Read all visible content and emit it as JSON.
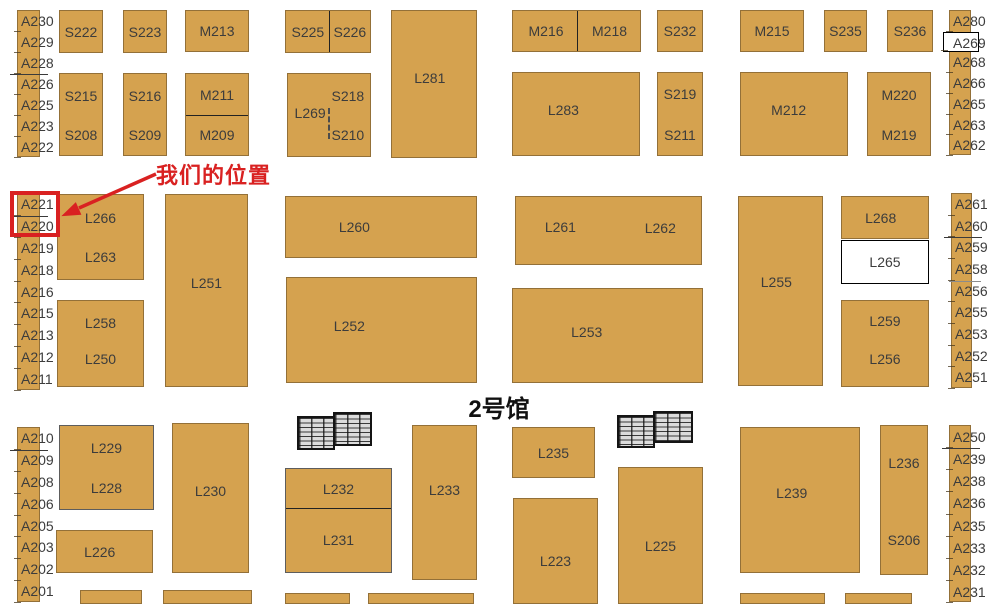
{
  "hall": {
    "title": "2号馆"
  },
  "annotation": {
    "label": "我们的位置"
  },
  "colors": {
    "booth_fill": "#d5a24f",
    "booth_border": "#5a462388",
    "label_text": "#3c3c3c",
    "divider": "#222222",
    "highlight": "#d92121",
    "hall_text": "#111111"
  },
  "strips": [
    {
      "name": "left-top",
      "x": 17,
      "y": 10,
      "w": 23,
      "h": 147,
      "labels": [
        {
          "t": "A230"
        },
        {
          "t": "A229"
        },
        {
          "t": "A228",
          "divider": true
        },
        {
          "t": "A226"
        },
        {
          "t": "A225"
        },
        {
          "t": "A223"
        },
        {
          "t": "A222"
        }
      ]
    },
    {
      "name": "left-mid",
      "x": 17,
      "y": 193,
      "w": 23,
      "h": 197,
      "labels": [
        {
          "t": "A221",
          "divider": true
        },
        {
          "t": "A220"
        },
        {
          "t": "A219"
        },
        {
          "t": "A218"
        },
        {
          "t": "A216"
        },
        {
          "t": "A215"
        },
        {
          "t": "A213"
        },
        {
          "t": "A212"
        },
        {
          "t": "A211"
        }
      ]
    },
    {
      "name": "left-bottom",
      "x": 17,
      "y": 427,
      "w": 23,
      "h": 175,
      "labels": [
        {
          "t": "A210",
          "divider": true
        },
        {
          "t": "A209"
        },
        {
          "t": "A208"
        },
        {
          "t": "A206"
        },
        {
          "t": "A205"
        },
        {
          "t": "A203"
        },
        {
          "t": "A202"
        },
        {
          "t": "A201"
        }
      ]
    },
    {
      "name": "right-top",
      "x": 949,
      "y": 10,
      "w": 22,
      "h": 145,
      "labels": [
        {
          "t": "A280"
        },
        {
          "t": "A269",
          "white_box": true
        },
        {
          "t": "A268"
        },
        {
          "t": "A266"
        },
        {
          "t": "A265"
        },
        {
          "t": "A263"
        },
        {
          "t": "A262"
        }
      ]
    },
    {
      "name": "right-mid",
      "x": 951,
      "y": 193,
      "w": 21,
      "h": 195,
      "labels": [
        {
          "t": "A261"
        },
        {
          "t": "A260",
          "divider": true
        },
        {
          "t": "A259"
        },
        {
          "t": "A258",
          "light_div": true
        },
        {
          "t": "A256"
        },
        {
          "t": "A255"
        },
        {
          "t": "A253"
        },
        {
          "t": "A252"
        },
        {
          "t": "A251"
        }
      ]
    },
    {
      "name": "right-bottom",
      "x": 949,
      "y": 425,
      "w": 22,
      "h": 177,
      "labels": [
        {
          "t": "A250",
          "divider": true
        },
        {
          "t": "A239"
        },
        {
          "t": "A238"
        },
        {
          "t": "A236"
        },
        {
          "t": "A235"
        },
        {
          "t": "A233"
        },
        {
          "t": "A232"
        },
        {
          "t": "A231"
        }
      ]
    }
  ],
  "booths": [
    {
      "id": "S222",
      "x": 59,
      "y": 10,
      "w": 44,
      "h": 43,
      "labels": [
        {
          "t": "S222"
        }
      ]
    },
    {
      "id": "S223",
      "x": 123,
      "y": 10,
      "w": 44,
      "h": 43,
      "labels": [
        {
          "t": "S223"
        }
      ]
    },
    {
      "id": "M213",
      "x": 185,
      "y": 10,
      "w": 64,
      "h": 42,
      "labels": [
        {
          "t": "M213"
        }
      ]
    },
    {
      "id": "S225-S226",
      "x": 285,
      "y": 10,
      "w": 86,
      "h": 43,
      "vdiv": 51,
      "labels": [
        {
          "t": "S225",
          "lx": 26
        },
        {
          "t": "S226",
          "lx": 76
        }
      ]
    },
    {
      "id": "L281",
      "x": 391,
      "y": 10,
      "w": 86,
      "h": 148,
      "labels": [
        {
          "t": "L281",
          "lx": 45,
          "ly": 46
        }
      ]
    },
    {
      "id": "M216-M218",
      "x": 512,
      "y": 10,
      "w": 129,
      "h": 42,
      "vdiv": 50,
      "labels": [
        {
          "t": "M216",
          "lx": 26
        },
        {
          "t": "M218",
          "lx": 76
        }
      ]
    },
    {
      "id": "S232",
      "x": 657,
      "y": 10,
      "w": 46,
      "h": 42,
      "labels": [
        {
          "t": "S232"
        }
      ]
    },
    {
      "id": "M215",
      "x": 740,
      "y": 10,
      "w": 64,
      "h": 42,
      "labels": [
        {
          "t": "M215"
        }
      ]
    },
    {
      "id": "S235",
      "x": 824,
      "y": 10,
      "w": 43,
      "h": 42,
      "labels": [
        {
          "t": "S235"
        }
      ]
    },
    {
      "id": "S236",
      "x": 887,
      "y": 10,
      "w": 46,
      "h": 42,
      "labels": [
        {
          "t": "S236"
        }
      ]
    },
    {
      "id": "S215-S208",
      "x": 59,
      "y": 73,
      "w": 44,
      "h": 83,
      "labels": [
        {
          "t": "S215",
          "ly": 27
        },
        {
          "t": "S208",
          "ly": 75
        }
      ]
    },
    {
      "id": "S216-S209",
      "x": 123,
      "y": 73,
      "w": 44,
      "h": 83,
      "labels": [
        {
          "t": "S216",
          "ly": 27
        },
        {
          "t": "S209",
          "ly": 75
        }
      ]
    },
    {
      "id": "M211-M209",
      "x": 185,
      "y": 73,
      "w": 64,
      "h": 83,
      "hdiv": 50,
      "labels": [
        {
          "t": "M211",
          "ly": 26
        },
        {
          "t": "M209",
          "ly": 75
        }
      ]
    },
    {
      "id": "L269-S218-S210",
      "x": 287,
      "y": 73,
      "w": 84,
      "h": 84,
      "dash": true,
      "labels": [
        {
          "t": "L269",
          "lx": 27,
          "ly": 47
        },
        {
          "t": "S218",
          "lx": 73,
          "ly": 27
        },
        {
          "t": "S210",
          "lx": 73,
          "ly": 74
        }
      ]
    },
    {
      "id": "L283",
      "x": 512,
      "y": 72,
      "w": 128,
      "h": 84,
      "labels": [
        {
          "t": "L283",
          "lx": 40,
          "ly": 45
        }
      ]
    },
    {
      "id": "S219-S211",
      "x": 657,
      "y": 72,
      "w": 46,
      "h": 84,
      "labels": [
        {
          "t": "S219",
          "ly": 26
        },
        {
          "t": "S211",
          "ly": 76
        }
      ]
    },
    {
      "id": "M212",
      "x": 740,
      "y": 72,
      "w": 108,
      "h": 84,
      "labels": [
        {
          "t": "M212",
          "lx": 45,
          "ly": 45
        }
      ]
    },
    {
      "id": "M220-M219",
      "x": 867,
      "y": 72,
      "w": 64,
      "h": 84,
      "labels": [
        {
          "t": "M220",
          "ly": 27
        },
        {
          "t": "M219",
          "ly": 75
        }
      ]
    },
    {
      "id": "L266-L263",
      "x": 57,
      "y": 194,
      "w": 87,
      "h": 86,
      "labels": [
        {
          "t": "L266",
          "ly": 27
        },
        {
          "t": "L263",
          "ly": 74
        }
      ]
    },
    {
      "id": "L258-L250",
      "x": 57,
      "y": 300,
      "w": 87,
      "h": 87,
      "labels": [
        {
          "t": "L258",
          "ly": 26
        },
        {
          "t": "L250",
          "ly": 68
        }
      ]
    },
    {
      "id": "L251",
      "x": 165,
      "y": 194,
      "w": 83,
      "h": 193,
      "labels": [
        {
          "t": "L251",
          "ly": 46
        }
      ]
    },
    {
      "id": "L260",
      "x": 285,
      "y": 196,
      "w": 192,
      "h": 62,
      "labels": [
        {
          "t": "L260",
          "lx": 36
        }
      ]
    },
    {
      "id": "L261-L262",
      "x": 515,
      "y": 196,
      "w": 187,
      "h": 69,
      "labels": [
        {
          "t": "L261",
          "lx": 24,
          "ly": 45
        },
        {
          "t": "L262",
          "lx": 78,
          "ly": 47
        }
      ]
    },
    {
      "id": "L252",
      "x": 286,
      "y": 277,
      "w": 191,
      "h": 106,
      "labels": [
        {
          "t": "L252",
          "lx": 33,
          "ly": 46
        }
      ]
    },
    {
      "id": "L253",
      "x": 512,
      "y": 288,
      "w": 191,
      "h": 95,
      "labels": [
        {
          "t": "L253",
          "lx": 39,
          "ly": 46
        }
      ]
    },
    {
      "id": "L255",
      "x": 738,
      "y": 196,
      "w": 85,
      "h": 190,
      "labels": [
        {
          "t": "L255",
          "lx": 45,
          "ly": 45
        }
      ]
    },
    {
      "id": "L268",
      "x": 841,
      "y": 196,
      "w": 88,
      "h": 43,
      "labels": [
        {
          "t": "L268",
          "lx": 45
        }
      ]
    },
    {
      "id": "L265",
      "x": 841,
      "y": 240,
      "w": 88,
      "h": 44,
      "style": "white",
      "labels": [
        {
          "t": "L265"
        }
      ]
    },
    {
      "id": "L259-L256",
      "x": 841,
      "y": 300,
      "w": 88,
      "h": 87,
      "labels": [
        {
          "t": "L259",
          "ly": 24
        },
        {
          "t": "L256",
          "ly": 68
        }
      ]
    },
    {
      "id": "L229-L228",
      "x": 59,
      "y": 425,
      "w": 95,
      "h": 85,
      "strong": true,
      "labels": [
        {
          "t": "L229",
          "ly": 26
        },
        {
          "t": "L228",
          "ly": 75
        }
      ]
    },
    {
      "id": "L226",
      "x": 56,
      "y": 530,
      "w": 97,
      "h": 43,
      "labels": [
        {
          "t": "L226",
          "lx": 45
        }
      ]
    },
    {
      "id": "L230",
      "x": 172,
      "y": 423,
      "w": 77,
      "h": 150,
      "labels": [
        {
          "t": "L230",
          "ly": 45
        }
      ]
    },
    {
      "id": "L232-L231",
      "x": 285,
      "y": 468,
      "w": 107,
      "h": 105,
      "strong": true,
      "hdiv": 38,
      "labels": [
        {
          "t": "L232",
          "ly": 19
        },
        {
          "t": "L231",
          "ly": 69
        }
      ]
    },
    {
      "id": "L233",
      "x": 412,
      "y": 425,
      "w": 65,
      "h": 155,
      "labels": [
        {
          "t": "L233",
          "ly": 42
        }
      ]
    },
    {
      "id": "L235",
      "x": 512,
      "y": 427,
      "w": 83,
      "h": 51,
      "labels": [
        {
          "t": "L235"
        }
      ]
    },
    {
      "id": "L223",
      "x": 513,
      "y": 498,
      "w": 85,
      "h": 106,
      "labels": [
        {
          "t": "L223",
          "ly": 60
        }
      ]
    },
    {
      "id": "L225",
      "x": 618,
      "y": 467,
      "w": 85,
      "h": 137,
      "labels": [
        {
          "t": "L225",
          "ly": 58
        }
      ]
    },
    {
      "id": "L239",
      "x": 740,
      "y": 427,
      "w": 120,
      "h": 146,
      "labels": [
        {
          "t": "L239",
          "lx": 43,
          "ly": 45
        }
      ]
    },
    {
      "id": "L236-S206",
      "x": 880,
      "y": 425,
      "w": 48,
      "h": 150,
      "labels": [
        {
          "t": "L236",
          "ly": 25
        },
        {
          "t": "S206",
          "ly": 77
        }
      ]
    },
    {
      "id": "",
      "x": 80,
      "y": 590,
      "w": 62,
      "h": 14,
      "labels": []
    },
    {
      "id": "",
      "x": 163,
      "y": 590,
      "w": 89,
      "h": 14,
      "labels": []
    },
    {
      "id": "",
      "x": 285,
      "y": 593,
      "w": 65,
      "h": 11,
      "labels": []
    },
    {
      "id": "",
      "x": 368,
      "y": 593,
      "w": 106,
      "h": 11,
      "labels": []
    },
    {
      "id": "",
      "x": 740,
      "y": 593,
      "w": 85,
      "h": 11,
      "labels": []
    },
    {
      "id": "",
      "x": 845,
      "y": 593,
      "w": 67,
      "h": 11,
      "labels": []
    }
  ],
  "hatches": [
    {
      "name": "stairs-hatch-left",
      "x": 297,
      "y": 412,
      "parts": [
        {
          "dx": 0,
          "dy": 4,
          "w": 38,
          "h": 34
        },
        {
          "dx": 36,
          "dy": 0,
          "w": 39,
          "h": 34
        }
      ]
    },
    {
      "name": "stairs-hatch-right",
      "x": 617,
      "y": 411,
      "parts": [
        {
          "dx": 0,
          "dy": 4,
          "w": 38,
          "h": 33
        },
        {
          "dx": 36,
          "dy": 0,
          "w": 40,
          "h": 32
        }
      ]
    }
  ],
  "arrow": {
    "x1": 156,
    "y1": 174,
    "x2": 79,
    "y2": 208,
    "tip": [
      64,
      215
    ]
  }
}
